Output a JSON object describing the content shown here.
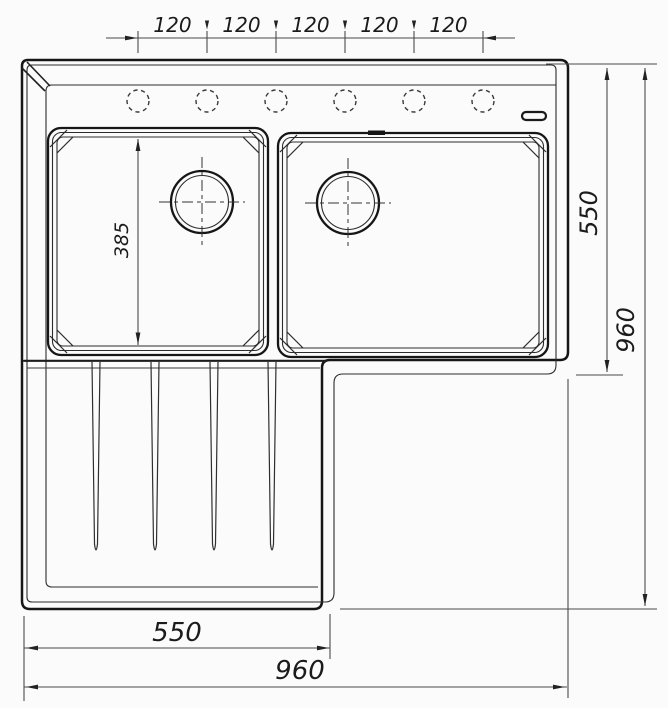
{
  "meta": {
    "title": "Sink technical drawing - top view",
    "units": "mm"
  },
  "drawing": {
    "subject": "double-bowl kitchen sink with left drainboard",
    "view": "top",
    "line_color": "#161616",
    "dim_color": "#4a4a4a",
    "background": "#fbfbfb"
  },
  "features": {
    "faucet_holes": {
      "count": 6,
      "style": "dashed-circle"
    },
    "bowls": {
      "count": 2,
      "drain_style": "double-circle-with-center-mark"
    },
    "drainboard_grooves": {
      "count": 4
    },
    "logo_mark": "small rounded rectangle on right rim"
  },
  "dims": {
    "top_pitch_labels": [
      "120",
      "120",
      "120",
      "120",
      "120"
    ],
    "bowl_depth": "385",
    "right_upper": "550",
    "right_total": "960",
    "bottom_left": "550",
    "bottom_total": "960"
  }
}
